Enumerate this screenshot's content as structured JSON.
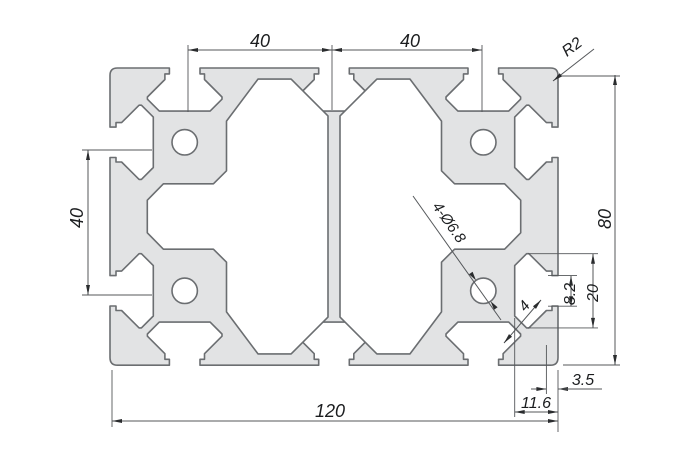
{
  "drawing": {
    "type": "technical-cad-cross-section",
    "subject": "aluminum-extrusion-profile",
    "background": "#ffffff",
    "profile_fill": "#e2e3e4",
    "profile_stroke": "#6b6e71",
    "dim_line_color": "#54575a",
    "dim_text_color": "#1b1d1f",
    "dimensions": {
      "top_left": "40",
      "top_right": "40",
      "side_left": "40",
      "height": "80",
      "width": "120",
      "radius": "R2",
      "holes": "4-Ø6.8",
      "chamfer": "4",
      "slot_opening": "8.2",
      "slot_width": "20",
      "lip_offset": "3.5",
      "slot_depth": "11.6"
    }
  }
}
